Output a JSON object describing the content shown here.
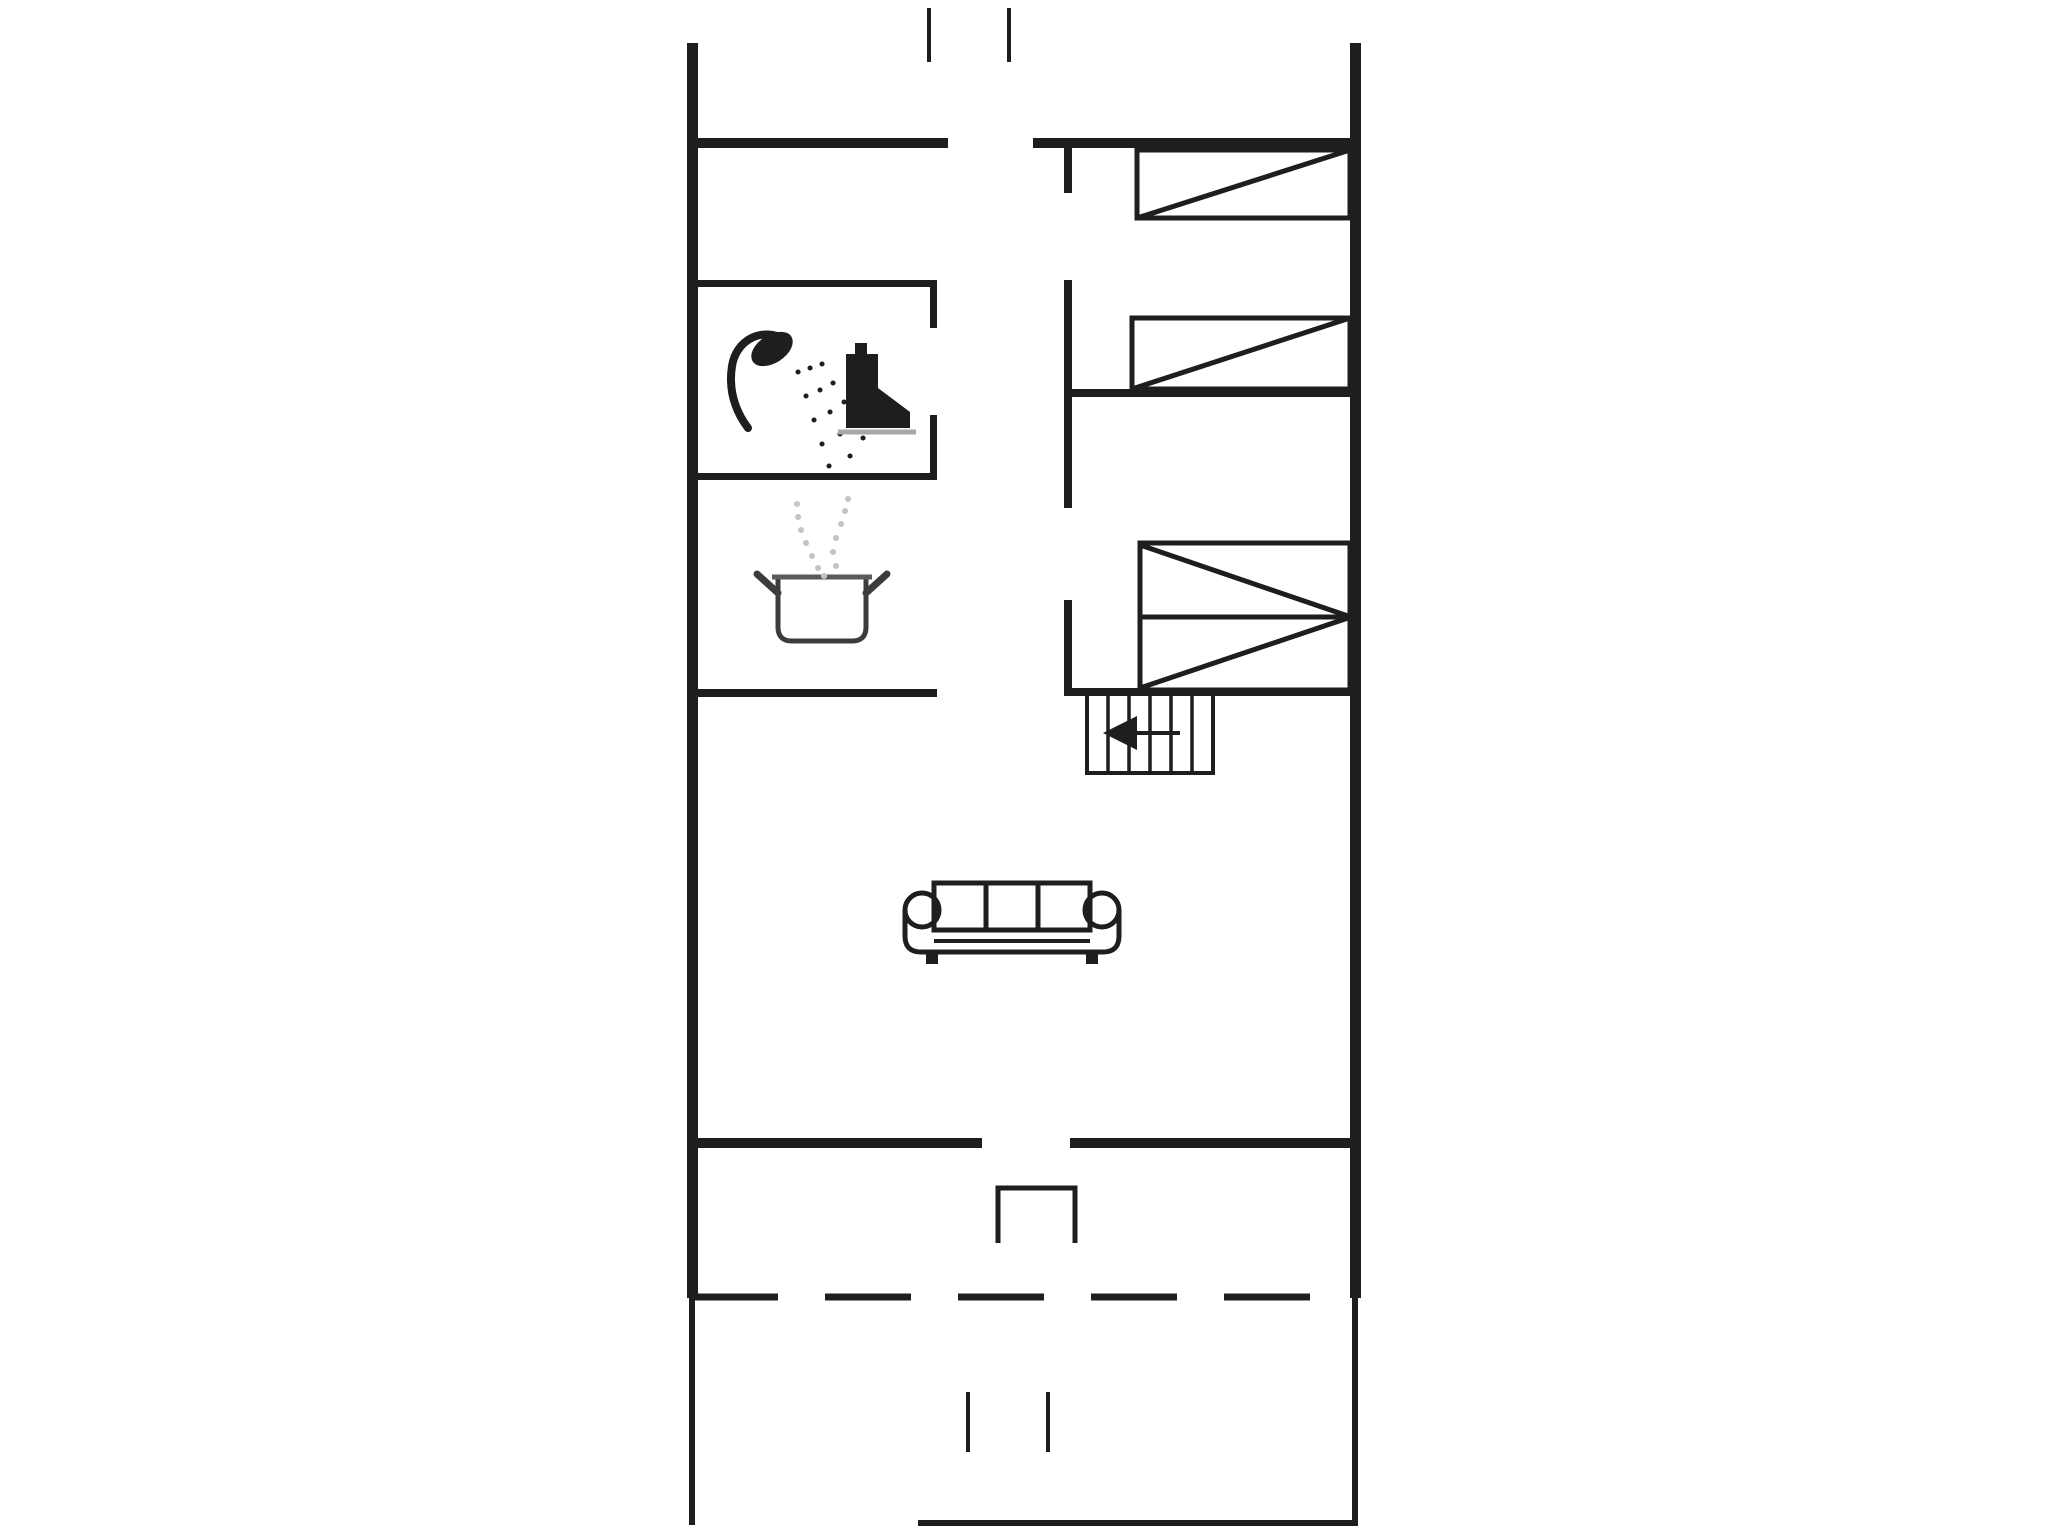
{
  "plan": {
    "palette": {
      "ink": "#1e1e1e",
      "muted": "#a8a8a8",
      "steam": "#c4c4c4",
      "pot": "#3c3c3c",
      "rim": "#5a5a5a"
    },
    "canvas": {
      "width": 2048,
      "height": 1536,
      "background": "#ffffff"
    },
    "shapes": [
      {
        "name": "left-outer-wall-upper",
        "tag": "rect",
        "attrs": {
          "x": 687,
          "y": 43,
          "width": 11,
          "height": 1255,
          "fill": "ink"
        }
      },
      {
        "name": "left-outer-wall-lower",
        "tag": "rect",
        "attrs": {
          "x": 689,
          "y": 1298,
          "width": 6,
          "height": 227,
          "fill": "ink"
        }
      },
      {
        "name": "right-outer-wall-upper",
        "tag": "rect",
        "attrs": {
          "x": 1350,
          "y": 43,
          "width": 11,
          "height": 1255,
          "fill": "ink"
        }
      },
      {
        "name": "right-outer-wall-lower",
        "tag": "rect",
        "attrs": {
          "x": 1352,
          "y": 1298,
          "width": 6,
          "height": 227,
          "fill": "ink"
        }
      },
      {
        "name": "top-wall-west",
        "tag": "rect",
        "attrs": {
          "x": 687,
          "y": 138,
          "width": 261,
          "height": 10,
          "fill": "ink"
        }
      },
      {
        "name": "top-wall-east",
        "tag": "rect",
        "attrs": {
          "x": 1033,
          "y": 138,
          "width": 328,
          "height": 10,
          "fill": "ink"
        }
      },
      {
        "name": "south-wall-west",
        "tag": "rect",
        "attrs": {
          "x": 687,
          "y": 1138,
          "width": 295,
          "height": 10,
          "fill": "ink"
        }
      },
      {
        "name": "south-wall-east",
        "tag": "rect",
        "attrs": {
          "x": 1070,
          "y": 1138,
          "width": 291,
          "height": 10,
          "fill": "ink"
        }
      },
      {
        "name": "bathroom-north-wall",
        "tag": "rect",
        "attrs": {
          "x": 692,
          "y": 280,
          "width": 245,
          "height": 7,
          "fill": "ink"
        }
      },
      {
        "name": "bathroom-east-wall-upper",
        "tag": "rect",
        "attrs": {
          "x": 930,
          "y": 280,
          "width": 7,
          "height": 48,
          "fill": "ink"
        }
      },
      {
        "name": "bathroom-east-wall-lower",
        "tag": "rect",
        "attrs": {
          "x": 930,
          "y": 415,
          "width": 7,
          "height": 65,
          "fill": "ink"
        }
      },
      {
        "name": "bathroom-south-wall",
        "tag": "rect",
        "attrs": {
          "x": 692,
          "y": 473,
          "width": 245,
          "height": 7,
          "fill": "ink"
        }
      },
      {
        "name": "kitchen-south-wall",
        "tag": "rect",
        "attrs": {
          "x": 692,
          "y": 689,
          "width": 245,
          "height": 8,
          "fill": "ink"
        }
      },
      {
        "name": "hallway-east-wall-stub",
        "tag": "rect",
        "attrs": {
          "x": 1064,
          "y": 148,
          "width": 8,
          "height": 45,
          "fill": "ink"
        }
      },
      {
        "name": "hallway-east-wall-mid",
        "tag": "rect",
        "attrs": {
          "x": 1064,
          "y": 280,
          "width": 8,
          "height": 228,
          "fill": "ink"
        }
      },
      {
        "name": "hallway-east-wall-south",
        "tag": "rect",
        "attrs": {
          "x": 1064,
          "y": 600,
          "width": 8,
          "height": 96,
          "fill": "ink"
        }
      },
      {
        "name": "bedroom-divider-wall",
        "tag": "rect",
        "attrs": {
          "x": 1064,
          "y": 389,
          "width": 297,
          "height": 8,
          "fill": "ink"
        }
      },
      {
        "name": "bedrooms-south-wall",
        "tag": "rect",
        "attrs": {
          "x": 1064,
          "y": 688,
          "width": 297,
          "height": 8,
          "fill": "ink"
        }
      },
      {
        "name": "terrace-south-edge",
        "tag": "rect",
        "attrs": {
          "x": 918,
          "y": 1520,
          "width": 440,
          "height": 6,
          "fill": "ink"
        }
      },
      {
        "name": "entrance-path-mark-left",
        "tag": "rect",
        "attrs": {
          "x": 927,
          "y": 8,
          "width": 4,
          "height": 54,
          "fill": "ink"
        }
      },
      {
        "name": "entrance-path-mark-right",
        "tag": "rect",
        "attrs": {
          "x": 1007,
          "y": 8,
          "width": 4,
          "height": 54,
          "fill": "ink"
        }
      },
      {
        "name": "terrace-path-mark-left",
        "tag": "rect",
        "attrs": {
          "x": 966,
          "y": 1392,
          "width": 4,
          "height": 60,
          "fill": "ink"
        }
      },
      {
        "name": "terrace-path-mark-right",
        "tag": "rect",
        "attrs": {
          "x": 1046,
          "y": 1392,
          "width": 4,
          "height": 60,
          "fill": "ink"
        }
      },
      {
        "name": "terrace-dashed-boundary",
        "tag": "line",
        "attrs": {
          "x1": 692,
          "y1": 1297,
          "x2": 1358,
          "y2": 1297,
          "stroke": "ink",
          "stroke-width": 7,
          "stroke-dasharray": "86 47"
        }
      },
      {
        "name": "terrace-door-step",
        "tag": "path",
        "attrs": {
          "d": "M998 1243 L998 1188 L1075 1188 L1075 1243",
          "fill": "none",
          "stroke": "ink",
          "stroke-width": 5
        }
      },
      {
        "name": "bed-1-frame",
        "tag": "rect",
        "attrs": {
          "x": 1137,
          "y": 150,
          "width": 213,
          "height": 68,
          "fill": "none",
          "stroke": "ink",
          "stroke-width": 5
        }
      },
      {
        "name": "bed-1-diagonal",
        "tag": "line",
        "attrs": {
          "x1": 1137,
          "y1": 218,
          "x2": 1350,
          "y2": 150,
          "stroke": "ink",
          "stroke-width": 5
        }
      },
      {
        "name": "bed-2-frame",
        "tag": "rect",
        "attrs": {
          "x": 1132,
          "y": 318,
          "width": 218,
          "height": 71,
          "fill": "none",
          "stroke": "ink",
          "stroke-width": 5
        }
      },
      {
        "name": "bed-2-diagonal",
        "tag": "line",
        "attrs": {
          "x1": 1132,
          "y1": 389,
          "x2": 1350,
          "y2": 318,
          "stroke": "ink",
          "stroke-width": 5
        }
      },
      {
        "name": "bunk-bed-frame",
        "tag": "rect",
        "attrs": {
          "x": 1140,
          "y": 543,
          "width": 210,
          "height": 147,
          "fill": "none",
          "stroke": "ink",
          "stroke-width": 5
        }
      },
      {
        "name": "bunk-bed-midline",
        "tag": "line",
        "attrs": {
          "x1": 1140,
          "y1": 617,
          "x2": 1350,
          "y2": 617,
          "stroke": "ink",
          "stroke-width": 5
        }
      },
      {
        "name": "bunk-bed-diagonal-upper",
        "tag": "line",
        "attrs": {
          "x1": 1140,
          "y1": 545,
          "x2": 1348,
          "y2": 616,
          "stroke": "ink",
          "stroke-width": 5
        }
      },
      {
        "name": "bunk-bed-diagonal-lower",
        "tag": "line",
        "attrs": {
          "x1": 1140,
          "y1": 688,
          "x2": 1348,
          "y2": 618,
          "stroke": "ink",
          "stroke-width": 5
        }
      },
      {
        "name": "staircase-outline",
        "tag": "rect",
        "attrs": {
          "x": 1087,
          "y": 693,
          "width": 126,
          "height": 80,
          "fill": "none",
          "stroke": "ink",
          "stroke-width": 4
        }
      },
      {
        "name": "staircase-step-1",
        "tag": "line",
        "attrs": {
          "x1": 1108,
          "y1": 693,
          "x2": 1108,
          "y2": 773,
          "stroke": "ink",
          "stroke-width": 3.5
        }
      },
      {
        "name": "staircase-step-2",
        "tag": "line",
        "attrs": {
          "x1": 1129,
          "y1": 693,
          "x2": 1129,
          "y2": 773,
          "stroke": "ink",
          "stroke-width": 3.5
        }
      },
      {
        "name": "staircase-step-3",
        "tag": "line",
        "attrs": {
          "x1": 1150,
          "y1": 693,
          "x2": 1150,
          "y2": 773,
          "stroke": "ink",
          "stroke-width": 3.5
        }
      },
      {
        "name": "staircase-step-4",
        "tag": "line",
        "attrs": {
          "x1": 1171,
          "y1": 693,
          "x2": 1171,
          "y2": 773,
          "stroke": "ink",
          "stroke-width": 3.5
        }
      },
      {
        "name": "staircase-step-5",
        "tag": "line",
        "attrs": {
          "x1": 1192,
          "y1": 693,
          "x2": 1192,
          "y2": 773,
          "stroke": "ink",
          "stroke-width": 3.5
        }
      },
      {
        "name": "staircase-direction-line",
        "tag": "line",
        "attrs": {
          "x1": 1180,
          "y1": 733,
          "x2": 1132,
          "y2": 733,
          "stroke": "ink",
          "stroke-width": 4
        }
      },
      {
        "name": "staircase-direction-arrowhead",
        "tag": "polygon",
        "attrs": {
          "points": "1103,733 1137,716 1137,750",
          "fill": "ink"
        }
      },
      {
        "name": "sofa-back-cushion-1",
        "tag": "rect",
        "attrs": {
          "x": 934,
          "y": 883,
          "width": 52,
          "height": 47,
          "fill": "none",
          "stroke": "ink",
          "stroke-width": 5
        }
      },
      {
        "name": "sofa-back-cushion-2",
        "tag": "rect",
        "attrs": {
          "x": 986,
          "y": 883,
          "width": 52,
          "height": 47,
          "fill": "none",
          "stroke": "ink",
          "stroke-width": 5
        }
      },
      {
        "name": "sofa-back-cushion-3",
        "tag": "rect",
        "attrs": {
          "x": 1038,
          "y": 883,
          "width": 52,
          "height": 47,
          "fill": "none",
          "stroke": "ink",
          "stroke-width": 5
        }
      },
      {
        "name": "sofa-left-armrest",
        "tag": "circle",
        "attrs": {
          "cx": 922,
          "cy": 910,
          "r": 17,
          "fill": "none",
          "stroke": "ink",
          "stroke-width": 5
        }
      },
      {
        "name": "sofa-right-armrest",
        "tag": "circle",
        "attrs": {
          "cx": 1102,
          "cy": 910,
          "r": 17,
          "fill": "none",
          "stroke": "ink",
          "stroke-width": 5
        }
      },
      {
        "name": "sofa-shell",
        "tag": "path",
        "attrs": {
          "d": "M905 910 L905 936 Q905 952 921 952 L1103 952 Q1119 952 1119 936 L1119 910",
          "fill": "none",
          "stroke": "ink",
          "stroke-width": 5
        }
      },
      {
        "name": "sofa-seat-line",
        "tag": "line",
        "attrs": {
          "x1": 934,
          "y1": 941,
          "x2": 1090,
          "y2": 941,
          "stroke": "ink",
          "stroke-width": 4
        }
      },
      {
        "name": "sofa-left-foot",
        "tag": "rect",
        "attrs": {
          "x": 926,
          "y": 952,
          "width": 12,
          "height": 12,
          "fill": "ink"
        }
      },
      {
        "name": "sofa-right-foot",
        "tag": "rect",
        "attrs": {
          "x": 1086,
          "y": 952,
          "width": 12,
          "height": 12,
          "fill": "ink"
        }
      },
      {
        "name": "cooking-pot-body-icon",
        "tag": "path",
        "attrs": {
          "d": "M778 577 L866 577 L866 627 Q866 641 852 641 L792 641 Q778 641 778 627 Z",
          "fill": "none",
          "stroke": "pot",
          "stroke-width": 5
        }
      },
      {
        "name": "cooking-pot-rim",
        "tag": "line",
        "attrs": {
          "x1": 772,
          "y1": 577,
          "x2": 872,
          "y2": 577,
          "stroke": "rim",
          "stroke-width": 5
        }
      },
      {
        "name": "cooking-pot-handle-left",
        "tag": "line",
        "attrs": {
          "x1": 778,
          "y1": 593,
          "x2": 757,
          "y2": 574,
          "stroke": "pot",
          "stroke-width": 7,
          "stroke-linecap": "round"
        }
      },
      {
        "name": "cooking-pot-handle-right",
        "tag": "line",
        "attrs": {
          "x1": 866,
          "y1": 593,
          "x2": 887,
          "y2": 574,
          "stroke": "pot",
          "stroke-width": 7,
          "stroke-linecap": "round"
        }
      },
      {
        "name": "steam-dots-icon",
        "tag": "path",
        "attrs": {
          "d": "M818 568h.1M812 556h.1M806 543h.1M801 530h.1M798 517h.1M797 504h.1M836 566h.1M833 552h.1M836 538h.1M841 524h.1M845 511h.1M848 499h.1M824 576h.1",
          "fill": "none",
          "stroke": "steam",
          "stroke-width": 6,
          "stroke-linecap": "round"
        }
      },
      {
        "name": "shower-head-icon",
        "tag": "ellipse",
        "attrs": {
          "cx": 772,
          "cy": 349,
          "rx": 23,
          "ry": 14,
          "fill": "ink",
          "transform": "rotate(-33 772 349)"
        }
      },
      {
        "name": "shower-hose",
        "tag": "path",
        "attrs": {
          "d": "M786 340 C762 326 736 340 732 366 C728 392 736 412 748 428",
          "fill": "none",
          "stroke": "ink",
          "stroke-width": 8,
          "stroke-linecap": "round"
        }
      },
      {
        "name": "shower-spray-dots",
        "tag": "path",
        "attrs": {
          "d": "M798 372h.1M806 396h.1M814 420h.1M822 444h.1M829 466h.1M810 368h.1M820 390h.1M830 412h.1M840 434h.1M850 456h.1M822 364h.1M833 383h.1M844 402h.1M854 420h.1M863 438h.1",
          "fill": "none",
          "stroke": "ink",
          "stroke-width": 5,
          "stroke-linecap": "round"
        }
      },
      {
        "name": "toilet-flush-button",
        "tag": "rect",
        "attrs": {
          "x": 855,
          "y": 343,
          "width": 12,
          "height": 11,
          "fill": "ink"
        }
      },
      {
        "name": "toilet-tank-icon",
        "tag": "rect",
        "attrs": {
          "x": 846,
          "y": 354,
          "width": 32,
          "height": 74,
          "fill": "ink"
        }
      },
      {
        "name": "toilet-bowl-icon",
        "tag": "path",
        "attrs": {
          "d": "M878 388 L910 412 L910 428 L878 428 Z",
          "fill": "ink"
        }
      },
      {
        "name": "toilet-base-line",
        "tag": "line",
        "attrs": {
          "x1": 838,
          "y1": 432,
          "x2": 916,
          "y2": 432,
          "stroke": "muted",
          "stroke-width": 5
        }
      }
    ]
  }
}
